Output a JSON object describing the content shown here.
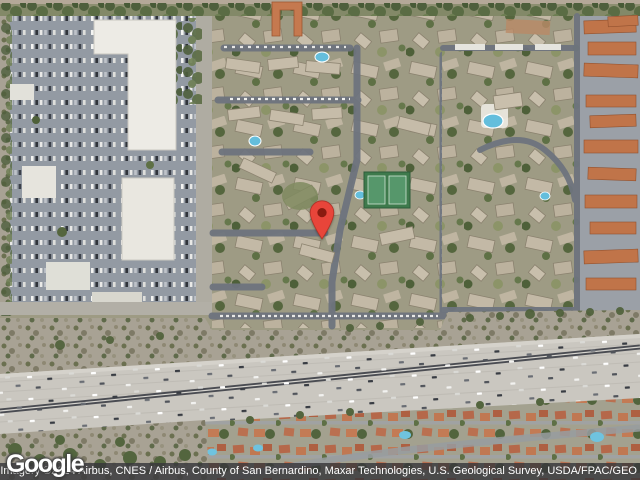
{
  "map": {
    "view_type": "satellite",
    "marker": {
      "x": 322,
      "y": 240,
      "color": "#E8453A",
      "outline_color": "#B03227",
      "dot_color": "#8A1B10"
    },
    "colors": {
      "pool": "#64BEDC",
      "tennis_court": "#3E7A4C",
      "tennis_inner": "#56976B",
      "freeway_pavement": "#CAC7C0",
      "freeway_median": "#4A4C52",
      "roof_tan": "#C6BCA9",
      "roof_red": "#C07449",
      "mall_roof_white": "#EDEBE5",
      "street_gray": "#6E747E",
      "vegetation_green": "#4E6039"
    }
  },
  "branding": {
    "logo_text": "Google"
  },
  "attribution": {
    "text": "Imagery ©2024 Airbus, CNES / Airbus, County of San Bernardino, Maxar Technologies, U.S. Geological Survey, USDA/FPAC/GEO"
  }
}
